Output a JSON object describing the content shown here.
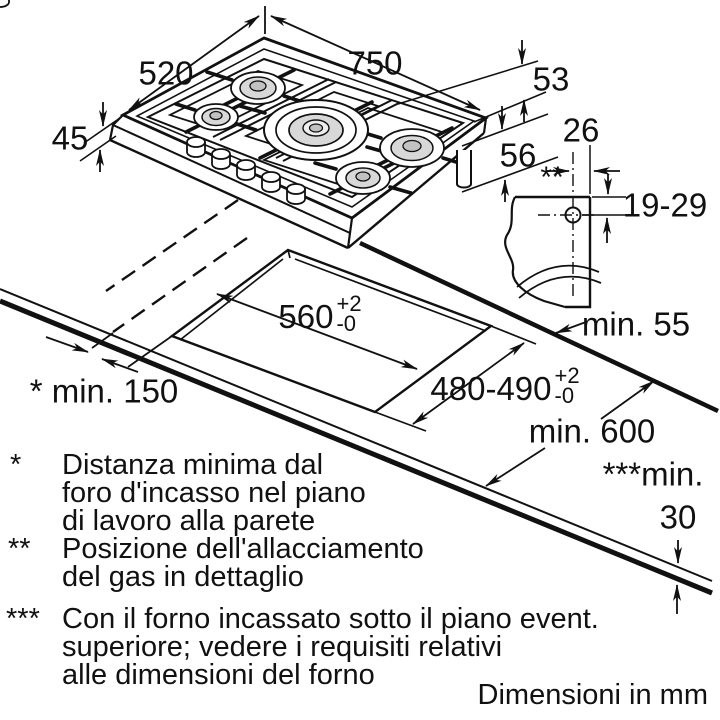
{
  "colors": {
    "line": "#111111",
    "burner_cap": "#d8d8d8",
    "burner_cap_dark": "#c2c2c2",
    "background": "#ffffff"
  },
  "dimensions": {
    "top_width": "750",
    "top_depth": "520",
    "height_left": "45",
    "height_right": "53",
    "gas_drop": "56",
    "gas_offset": "26",
    "gas_marker": "**",
    "gas_vertical_range": "19-29",
    "cutout_width": {
      "value": "560",
      "tol_plus": "+2",
      "tol_minus": "-0"
    },
    "cutout_depth": {
      "value": "480-490",
      "tol_plus": "+2",
      "tol_minus": "-0"
    },
    "min_wall_side": "* min. 150",
    "min_wall_back": "min. 55",
    "min_depth": "min. 600",
    "min_thickness_prefix": "***min.",
    "min_thickness_value": "30"
  },
  "footnotes": {
    "n1": {
      "marker": "*",
      "line1": "Distanza minima dal",
      "line2": "foro d'incasso nel piano",
      "line3": "di lavoro alla parete"
    },
    "n2": {
      "marker": "**",
      "line1": "Posizione dell'allacciamento",
      "line2": "del gas in dettaglio"
    },
    "n3": {
      "marker": "***",
      "line1": "Con il forno incassato sotto il piano event.",
      "line2": "superiore; vedere i requisiti relativi",
      "line3": "alle dimensioni del forno"
    }
  },
  "units_note": "Dimensioni in mm"
}
